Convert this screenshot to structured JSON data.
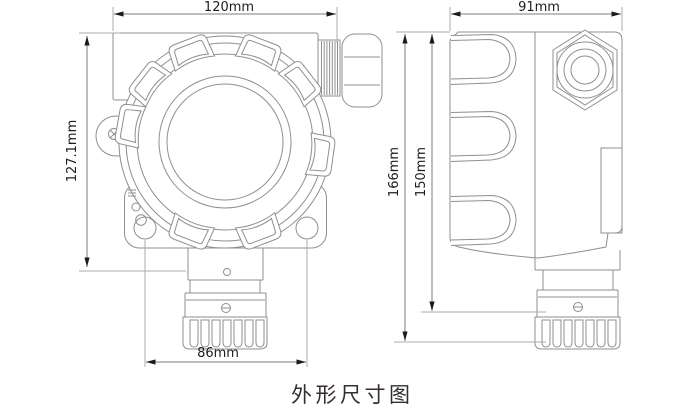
{
  "caption": "外形尺寸图",
  "dimensions": {
    "front_width": "120mm",
    "front_height": "127.1mm",
    "front_hole_spacing": "86mm",
    "side_width": "91mm",
    "side_overall_height": "166mm",
    "side_body_height": "150mm"
  },
  "colors": {
    "device_line": "#8f8f8f",
    "extension_line": "#ababab",
    "dimension_line": "#7c7c7c",
    "arrow": "#1b1b1b",
    "dimension_text": "#1d1d1d",
    "caption_text": "#342f2c",
    "background": "#ffffff"
  }
}
